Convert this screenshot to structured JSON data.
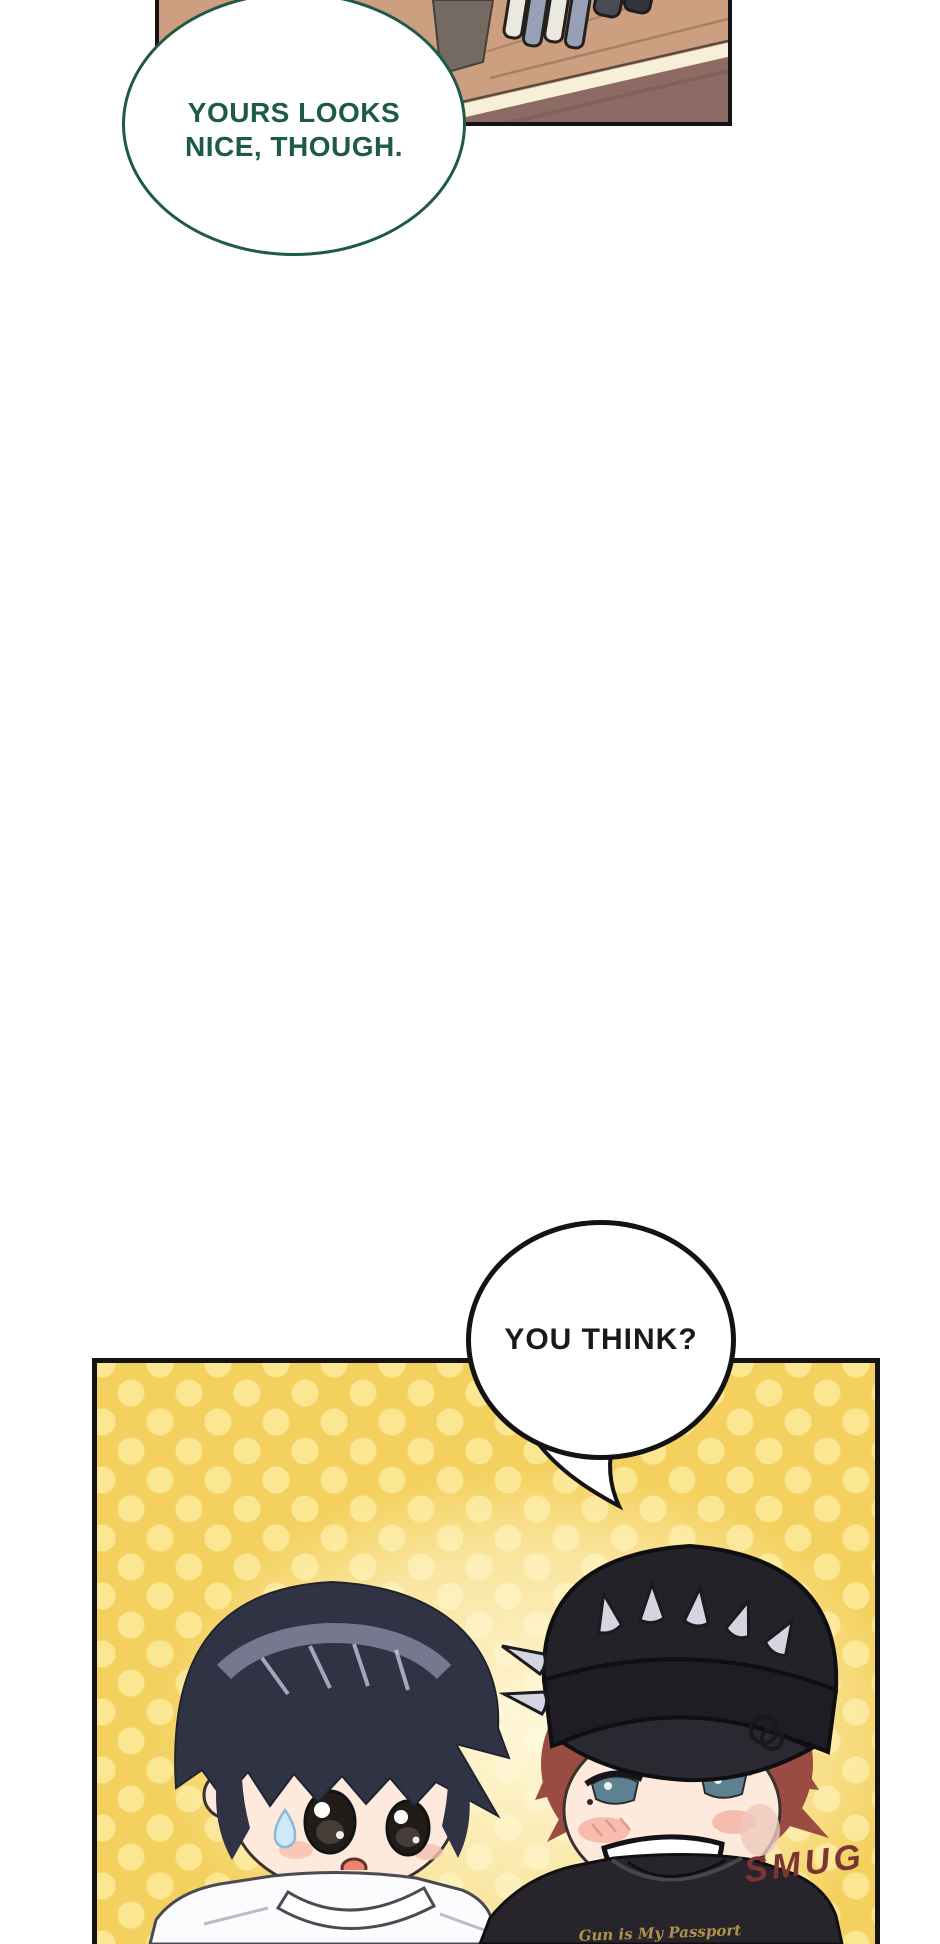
{
  "bubbles": {
    "top": {
      "line1": "YOURS LOOKS",
      "line2": "NICE, THOUGH.",
      "text_color": "#1d5a47",
      "border_color": "#1d5a47"
    },
    "you_think": {
      "text": "YOU THINK?",
      "text_color": "#1a1a1a",
      "border_color": "#131313"
    }
  },
  "sfx": {
    "smug": {
      "text": "SMUG",
      "color": "#7d3434"
    }
  },
  "characters": {
    "left_boy": {
      "description": "chibi boy, dark navy hair, white t-shirt, sweat drop on cheek"
    },
    "right_boy": {
      "description": "chibi boy, auburn hair, black spiked cap, hoop earring, black t-shirt",
      "shirt_text": "Gun is My Passport"
    }
  },
  "panels": {
    "top_panel": {
      "content": "wooden desk corner with markers",
      "base_color": "#cd9f81",
      "floor_color": "#8d6b64",
      "trim_color": "#f7f0d8"
    },
    "bottom_panel": {
      "content": "two chibi boys on yellow polka-dot background",
      "base_color": "#f4d15f",
      "dot_color": "#fce794",
      "border_color": "#131313"
    }
  }
}
